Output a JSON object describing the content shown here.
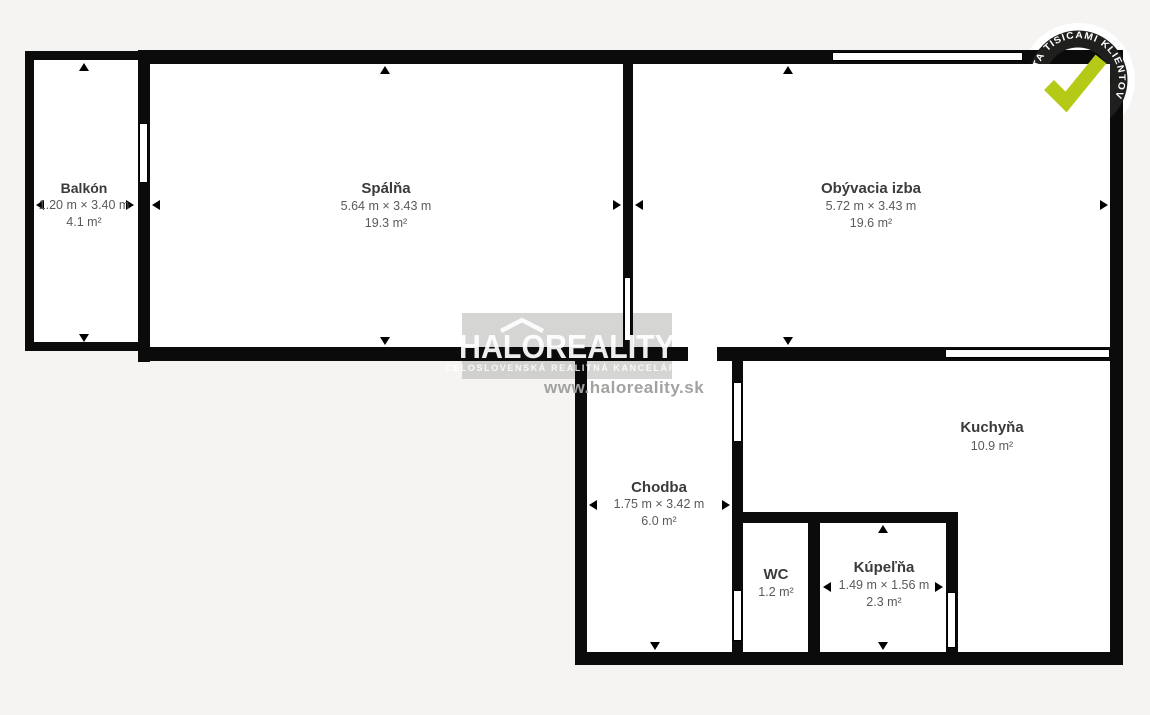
{
  "floorplan": {
    "rooms": [
      {
        "name": "Balkón",
        "dimensions": "1.20 m × 3.40 m",
        "area": "4.1 m²"
      },
      {
        "name": "Spálňa",
        "dimensions": "5.64 m × 3.43 m",
        "area": "19.3 m²"
      },
      {
        "name": "Obývacia izba",
        "dimensions": "5.72 m × 3.43 m",
        "area": "19.6 m²"
      },
      {
        "name": "Kuchyňa",
        "dimensions": "",
        "area": "10.9 m²"
      },
      {
        "name": "Chodba",
        "dimensions": "1.75 m × 3.42 m",
        "area": "6.0 m²"
      },
      {
        "name": "WC",
        "dimensions": "",
        "area": "1.2 m²"
      },
      {
        "name": "Kúpeľňa",
        "dimensions": "1.49 m × 1.56 m",
        "area": "2.3 m²"
      }
    ]
  },
  "watermark": {
    "logo": "HALOREALITY",
    "tagline": "CELOSLOVENSKÁ REALITNÁ KANCELÁRIA",
    "website": "www.haloreality.sk"
  },
  "badge": {
    "ring_text": "KVALITA TISÍCAMI KLIENTOV",
    "check_color": "#b5ca16",
    "ring_color": "#1f1f1d"
  },
  "colors": {
    "background": "#f5f4f2",
    "wall": "#0b0b0b",
    "room_fill": "#ffffff",
    "label_text": "#3b3b3b",
    "dim_text": "#5a5a5a"
  }
}
